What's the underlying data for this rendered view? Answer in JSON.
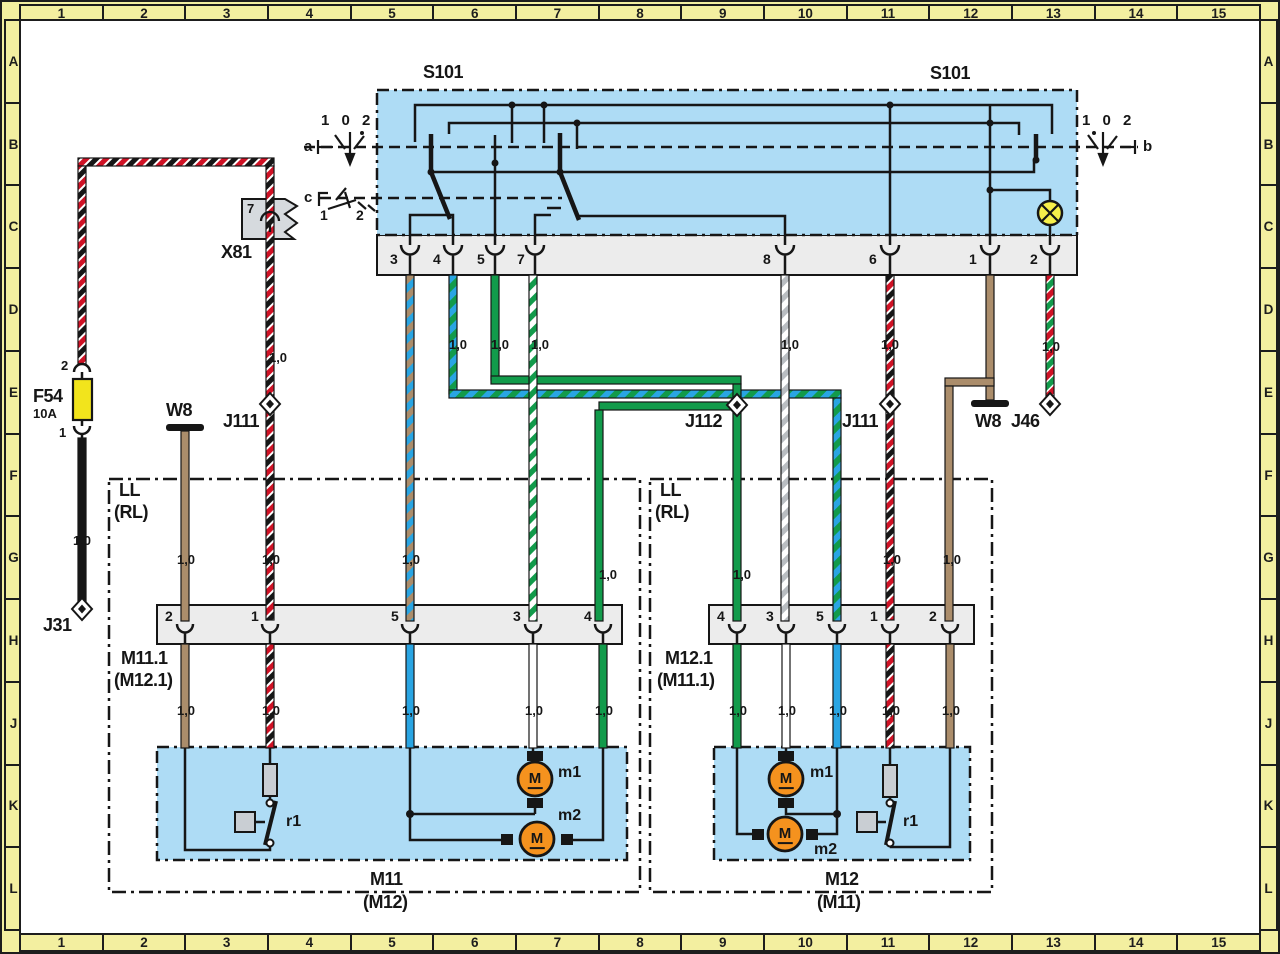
{
  "grid": {
    "columns": [
      "1",
      "2",
      "3",
      "4",
      "5",
      "6",
      "7",
      "8",
      "9",
      "10",
      "11",
      "12",
      "13",
      "14",
      "15"
    ],
    "rows": [
      "A",
      "B",
      "C",
      "D",
      "E",
      "F",
      "G",
      "H",
      "J",
      "K",
      "L"
    ]
  },
  "labels": {
    "gauge": "1,0",
    "motor": "M"
  },
  "s101": {
    "name": "S101",
    "name_right": "S101",
    "pins": [
      "3",
      "4",
      "5",
      "7",
      "8",
      "6",
      "1",
      "2"
    ],
    "switch_a": {
      "positions": "1 0 2",
      "label": "a"
    },
    "switch_b": {
      "positions": "1 0 2",
      "label": "b"
    },
    "switch_c": {
      "label": "c",
      "pos1": "1",
      "pos2": "2"
    }
  },
  "x81": {
    "name": "X81",
    "pin": "7"
  },
  "f54": {
    "name": "F54",
    "rating": "10A",
    "pin_top": "2",
    "pin_bottom": "1"
  },
  "w8_left": {
    "name": "W8"
  },
  "w8_right": {
    "name": "W8"
  },
  "j31": {
    "name": "J31"
  },
  "j46": {
    "name": "J46"
  },
  "j111_left": {
    "name": "J111"
  },
  "j111_right": {
    "name": "J111"
  },
  "j112": {
    "name": "J112"
  },
  "ll_left": {
    "title": "LL",
    "subtitle": "(RL)",
    "connector": {
      "name": "M11.1",
      "alt": "(M12.1)",
      "pins": [
        "2",
        "1",
        "5",
        "3",
        "4"
      ]
    },
    "unit": {
      "name": "M11",
      "alt": "(M12)",
      "m1": "m1",
      "m2": "m2",
      "r1": "r1"
    }
  },
  "ll_right": {
    "title": "LL",
    "subtitle": "(RL)",
    "connector": {
      "name": "M12.1",
      "alt": "(M11.1)",
      "pins": [
        "4",
        "3",
        "5",
        "1",
        "2"
      ]
    },
    "unit": {
      "name": "M12",
      "alt": "(M11)",
      "m1": "m1",
      "m2": "m2",
      "r1": "r1"
    }
  },
  "colors": {
    "band_yellow": "#f3efa0",
    "panel_blue": "#aedcf5",
    "strip_gray": "#ececec",
    "wire_brown": "#ab8d6b",
    "wire_blue": "#29a5e3",
    "wire_green": "#129b4b",
    "wire_red": "#cf1225",
    "wire_black": "#161616",
    "wire_gray": "#b9bdc1",
    "motor_orange": "#f5921e",
    "fuse_yellow": "#f2e41c",
    "lamp_yellow": "#f7ef4a"
  }
}
